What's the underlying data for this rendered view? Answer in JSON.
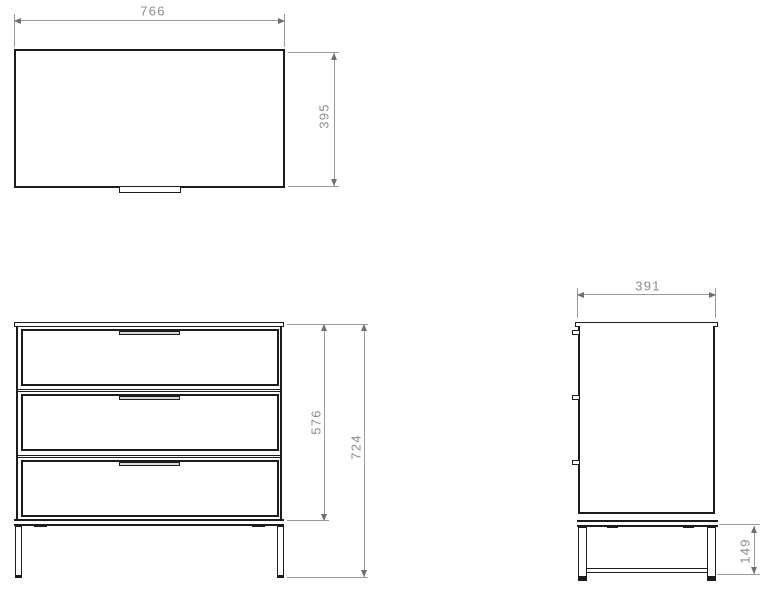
{
  "views": {
    "plan": {
      "width_label": "766",
      "depth_label": "395"
    },
    "front": {
      "cabinet_height_label": "576",
      "overall_height_label": "724",
      "drawer_count": 3
    },
    "side": {
      "depth_label": "391",
      "leg_height_label": "149"
    }
  },
  "colors": {
    "outline": "#1c1c1c",
    "dimension_line": "#9a9a9a",
    "dimension_text": "#8c8c8c",
    "background": "#ffffff"
  }
}
